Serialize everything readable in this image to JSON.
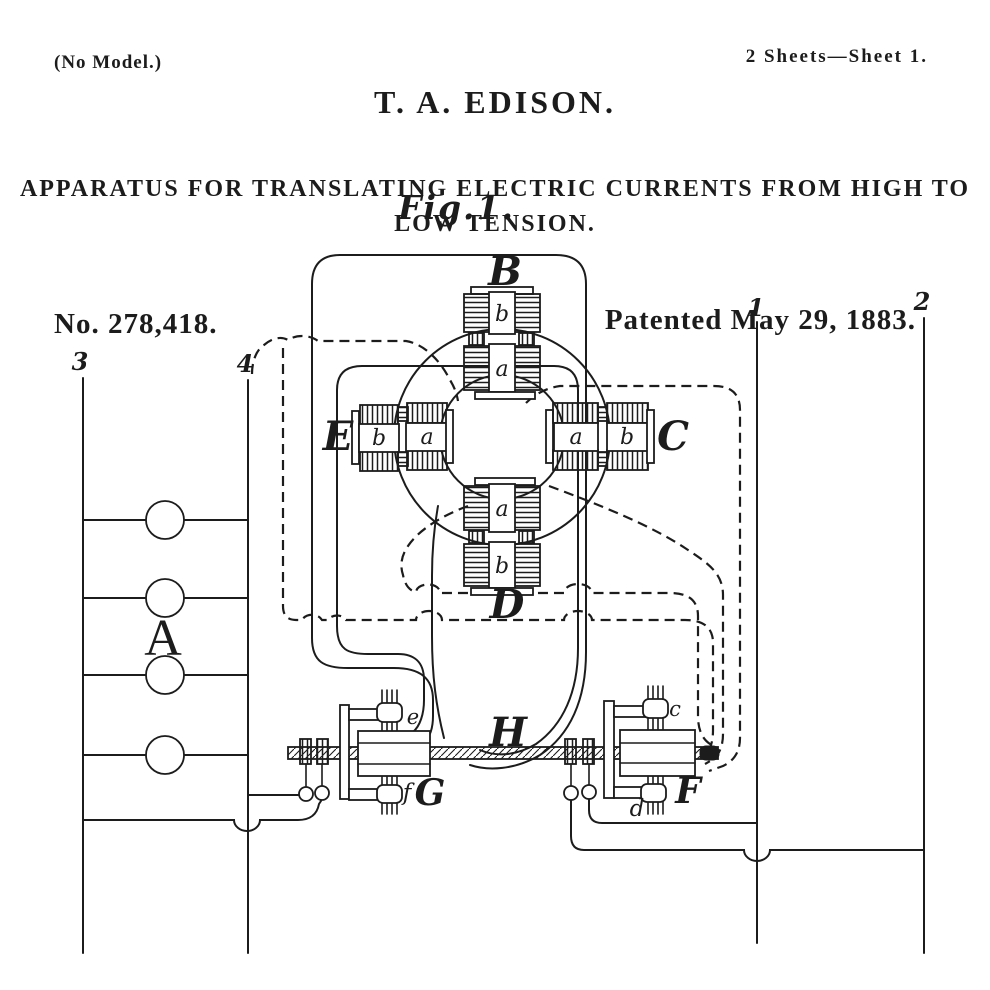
{
  "header": {
    "no_model": "(No Model.)",
    "sheet_info": "2 Sheets—Sheet 1.",
    "inventor": "T. A. EDISON.",
    "title_line1": "APPARATUS FOR TRANSLATING ELECTRIC CURRENTS FROM HIGH TO",
    "title_line2": "LOW TENSION.",
    "patent_number": "No. 278,418.",
    "patent_date": "Patented May 29, 1883."
  },
  "figure": {
    "label": "Fig.1.",
    "induction_ring": {
      "top_coil": "B",
      "right_coil": "C",
      "bottom_coil": "D",
      "left_coil": "E",
      "primary_winding": "a",
      "secondary_winding": "b"
    },
    "lamp_bank": {
      "label": "A"
    },
    "shaft": {
      "label": "H"
    },
    "commutator_left": {
      "label": "G",
      "upper_brush": "e",
      "lower_brush": "f"
    },
    "commutator_right": {
      "label": "F",
      "upper_brush": "c",
      "lower_brush": "d"
    },
    "mains": {
      "line1": "1",
      "line2": "2",
      "line3": "3",
      "line4": "4"
    }
  },
  "colors": {
    "ink": "#1c1c1c",
    "paper": "#ffffff"
  }
}
